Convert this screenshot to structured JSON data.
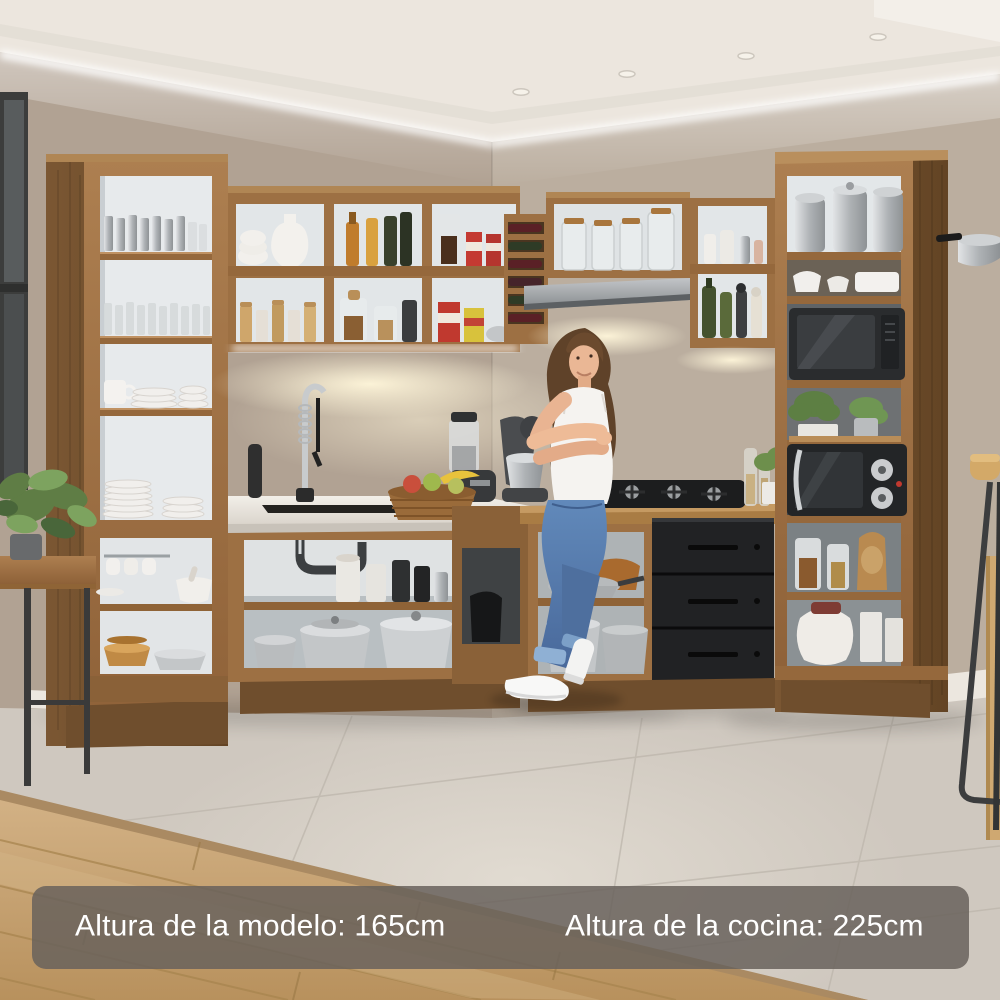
{
  "banner": {
    "model_height_label": "Altura de la modelo: 165cm",
    "kitchen_height_label": "Altura de la cocina: 225cm"
  },
  "scene": {
    "setting": "corner kitchen with rustic wood open-shelf cabinets and a standing model",
    "objects": [
      "left tall shelf tower",
      "upper wall cubbies",
      "wine rack",
      "glass jar cabinet",
      "range hood",
      "spice cubbies",
      "right tall shelf tower",
      "black microwave",
      "black toaster oven",
      "sink with spring faucet",
      "gas cooktop",
      "black three-drawer unit",
      "pots and pans shelves",
      "fruit basket",
      "blender",
      "stand mixer",
      "potted plant",
      "side bench",
      "bar stool",
      "hanging pot",
      "woman model"
    ],
    "colors": {
      "cabinet_wood": "#a3754a",
      "cabinet_wood_dark": "#73512f",
      "wall_left": "#b1a293",
      "wall_back": "#bbae9f",
      "ceiling": "#ece6de",
      "floor_tile": "#cfc8bf",
      "floor_wood": "#c9a87a",
      "black_unit": "#212224",
      "countertop": "#efece6",
      "jeans": "#5d83b4",
      "banner_background": "rgba(104,98,92,0.85)",
      "banner_text": "#ffffff"
    }
  }
}
